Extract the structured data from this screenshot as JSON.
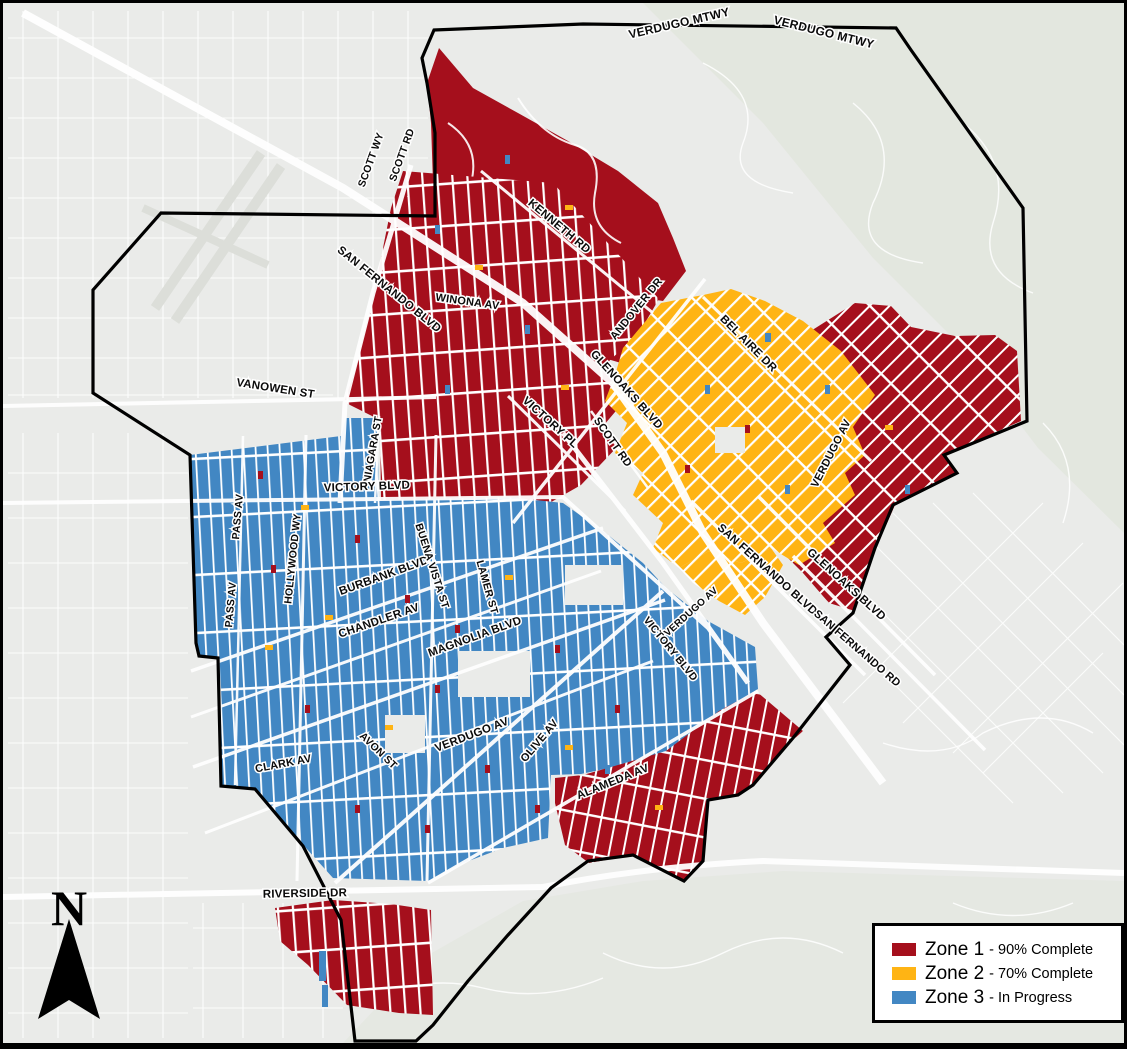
{
  "map": {
    "street_labels": [
      {
        "text": "VERDUGO MTWY"
      },
      {
        "text": "VERDUGO MTWY"
      },
      {
        "text": "SCOTT WY"
      },
      {
        "text": "SCOTT RD"
      },
      {
        "text": "KENNETH RD"
      },
      {
        "text": "SAN FERNANDO BLVD"
      },
      {
        "text": "WINONA AV"
      },
      {
        "text": "ANDOVER DR"
      },
      {
        "text": "BEL AIRE DR"
      },
      {
        "text": "GLENOAKS BLVD"
      },
      {
        "text": "SCOTT RD"
      },
      {
        "text": "VANOWEN ST"
      },
      {
        "text": "VICTORY PL"
      },
      {
        "text": "NIAGARA ST"
      },
      {
        "text": "VICTORY BLVD"
      },
      {
        "text": "PASS AV"
      },
      {
        "text": "PASS AV"
      },
      {
        "text": "HOLLYWOOD WY"
      },
      {
        "text": "BURBANK BLVD"
      },
      {
        "text": "BUENA VISTA ST"
      },
      {
        "text": "LAMER ST"
      },
      {
        "text": "VERDUGO AV"
      },
      {
        "text": "SAN FERNANDO BLVD"
      },
      {
        "text": "GLENOAKS BLVD"
      },
      {
        "text": "SAN FERNANDO RD"
      },
      {
        "text": "CHANDLER AV"
      },
      {
        "text": "MAGNOLIA BLVD"
      },
      {
        "text": "VICTORY BLVD"
      },
      {
        "text": "VERDUGO AV"
      },
      {
        "text": "AVON ST"
      },
      {
        "text": "VERDUGO AV"
      },
      {
        "text": "OLIVE AV"
      },
      {
        "text": "CLARK AV"
      },
      {
        "text": "ALAMEDA AV"
      },
      {
        "text": "RIVERSIDE DR"
      }
    ]
  },
  "legend": {
    "items": [
      {
        "label": "Zone 1",
        "desc": "- 90% Complete",
        "color": "#a50f1c"
      },
      {
        "label": "Zone 2",
        "desc": "- 70% Complete",
        "color": "#ffb414"
      },
      {
        "label": "Zone 3",
        "desc": "- In Progress",
        "color": "#4287c3"
      }
    ]
  },
  "compass": {
    "label": "N"
  },
  "colors": {
    "zone1": "#a50f1c",
    "zone2": "#ffb414",
    "zone3": "#4287c3",
    "background": "#eaebe9",
    "hills": "#e3e7df",
    "road": "#ffffff",
    "boundary": "#000000"
  }
}
